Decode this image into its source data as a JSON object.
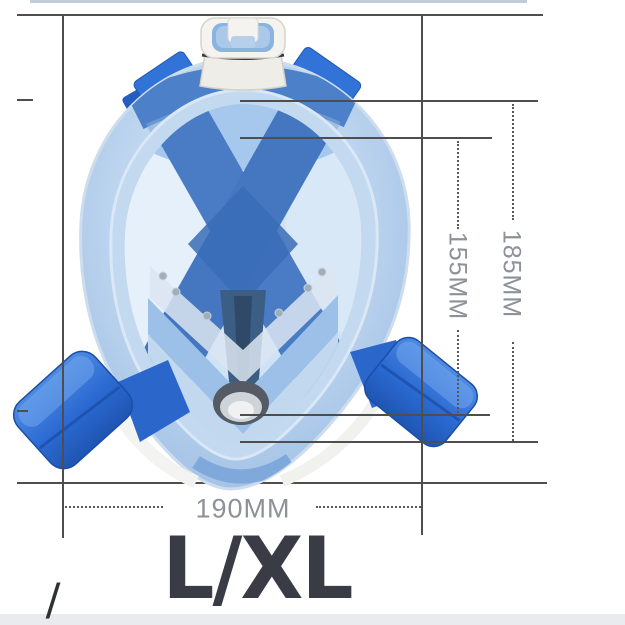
{
  "image": {
    "subject": "Full face snorkel mask product photo with dimension annotations",
    "size_label": "L/XL",
    "stray_mark": "/"
  },
  "dimensions": {
    "width_label": "190MM",
    "inner_height_label": "155MM",
    "outer_height_label": "185MM"
  },
  "colors": {
    "annotation_line": "#4e4e4e",
    "dimension_text": "#8d9298",
    "size_text": "#393c44",
    "strap_blue": "#2f6fd6",
    "skirt_blue": "#bcd4ee",
    "top_edge_artifact": "#bfcdda",
    "bottom_strip": "#e9ebee"
  }
}
